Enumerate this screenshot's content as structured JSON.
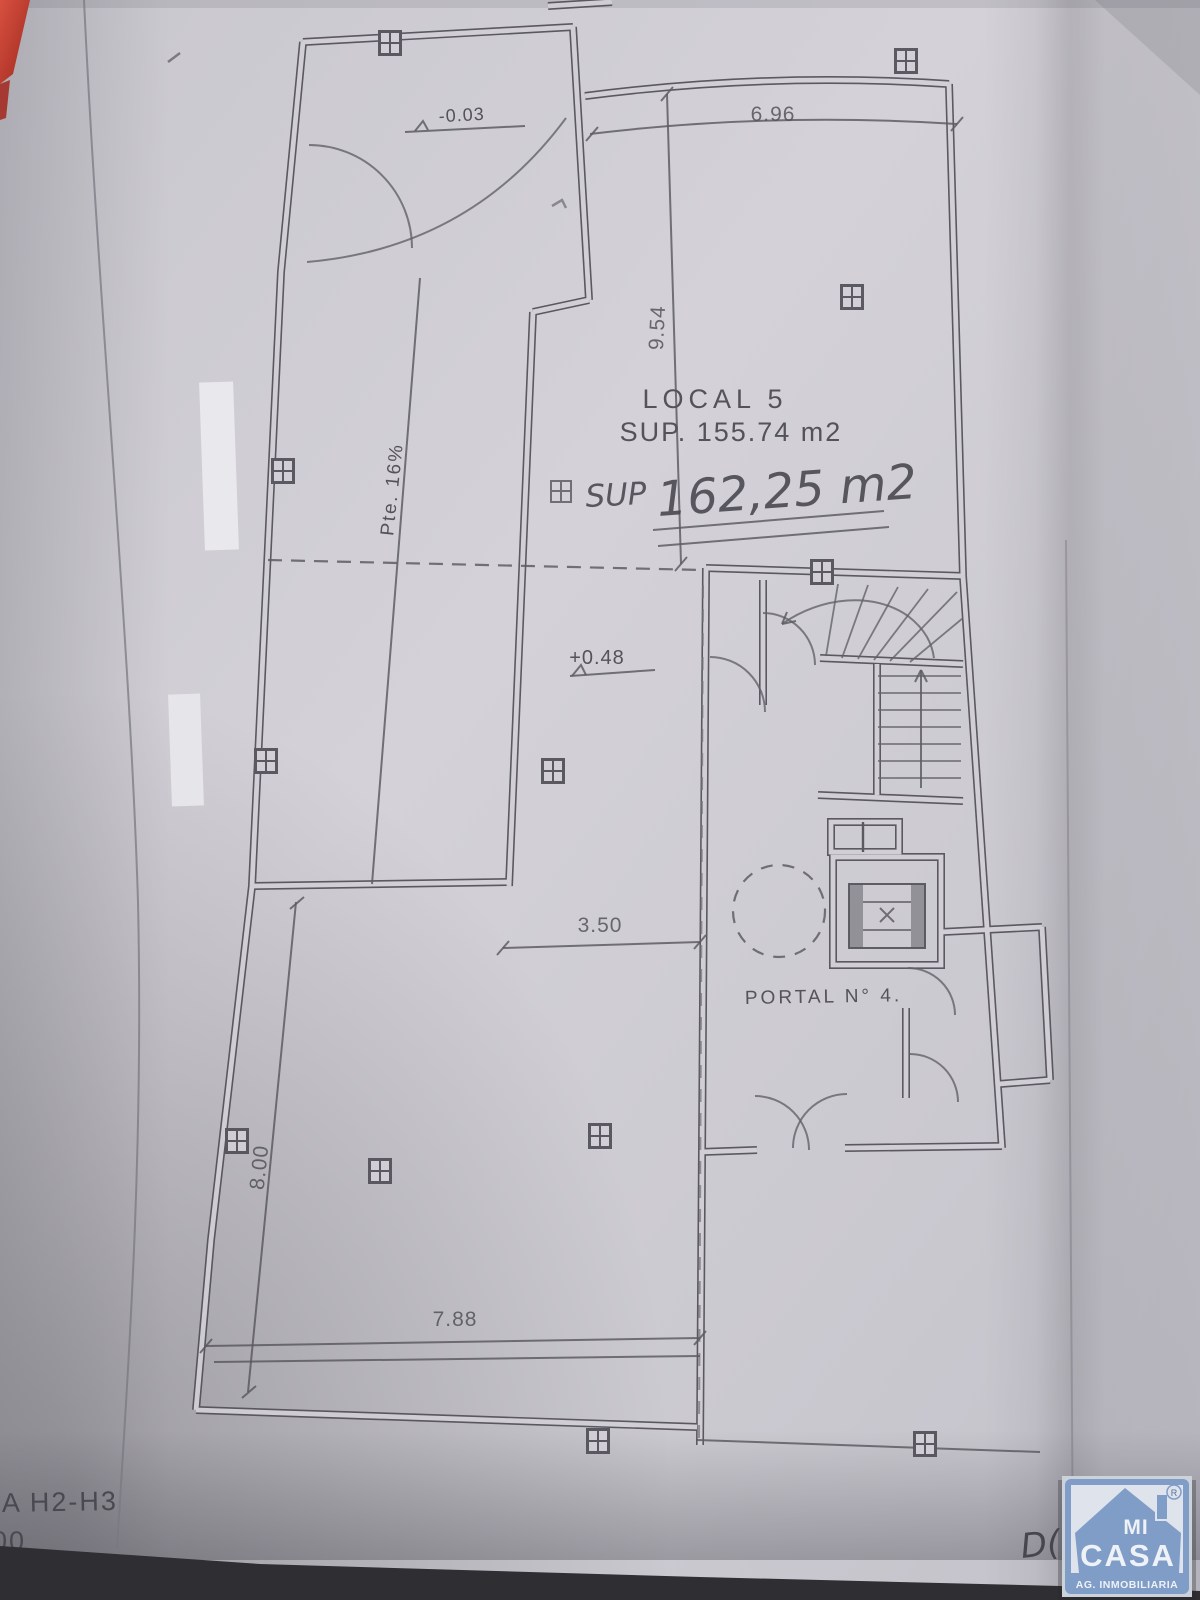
{
  "photo": {
    "paper_color": "#d2d0d6",
    "ink_color": "#514f57",
    "red_edge_color": "#b63528",
    "shadow_band_color": "#2f2e33"
  },
  "plan": {
    "title": "LOCAL 5",
    "area_line": "SUP. 155.74 m2",
    "handwritten_note": {
      "prefix": "SUP",
      "value": "162,25 m2"
    },
    "labels": {
      "slope": "Pte. 16%",
      "portal": "PORTAL N° 4.",
      "level_upper": "-0.03",
      "level_main": "+0.48"
    },
    "dimensions": {
      "top_width": "6.96",
      "local_depth": "9.54",
      "opening_width": "3.50",
      "bottom_width": "7.88",
      "left_depth": "8.00"
    }
  },
  "footer": {
    "sheet_reference": "A H2-H3",
    "scale_fragment": "00",
    "stray_mark": "D("
  },
  "logo": {
    "top_word": "MI",
    "bottom_word": "CASA",
    "subtitle": "AG. INMOBILIARIA",
    "registered_mark": "®",
    "blue": "#7f9dc6"
  }
}
